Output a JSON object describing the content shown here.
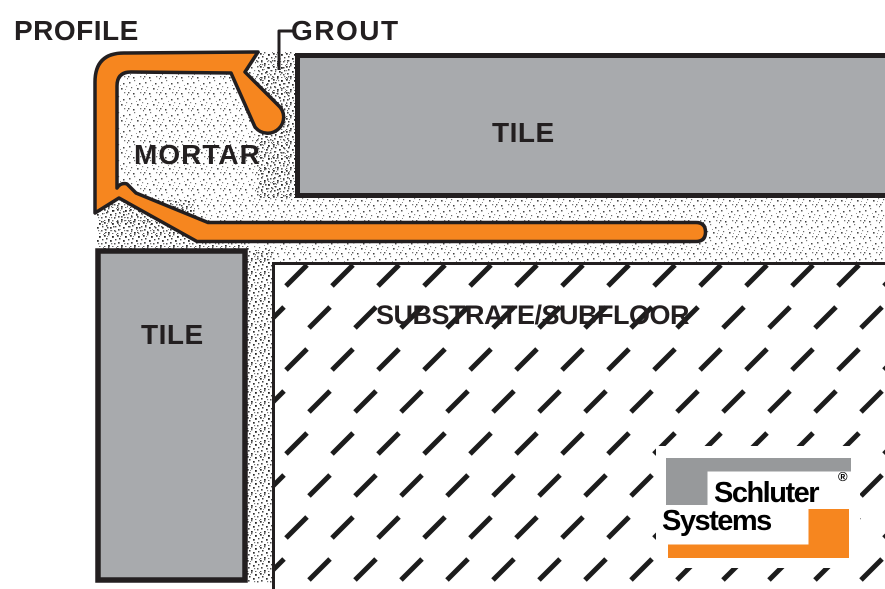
{
  "diagram": {
    "labels": {
      "profile": "PROFILE",
      "grout": "GROUT",
      "mortar": "MORTAR",
      "tile_top": "TILE",
      "tile_left": "TILE",
      "substrate": "SUBSTRATE/SUBFLOOR"
    },
    "colors": {
      "profile_orange": "#F6861F",
      "tile_gray": "#A8AAAD",
      "logo_gray": "#97999B",
      "outline_black": "#231F20"
    }
  },
  "logo": {
    "line1": "Schluter",
    "line2": "Systems",
    "registered": "®"
  }
}
